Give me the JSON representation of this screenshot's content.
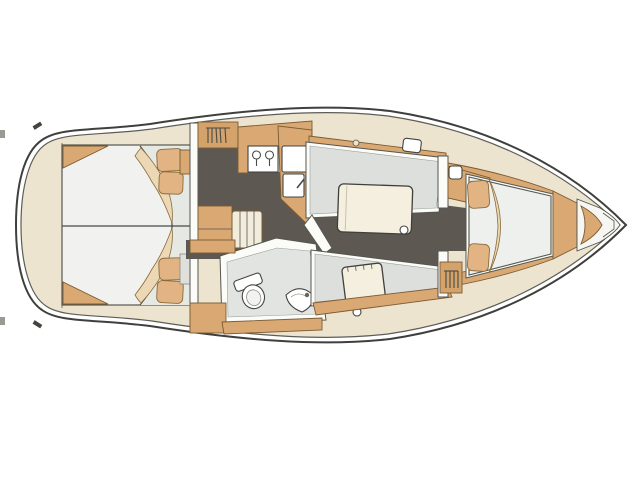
{
  "diagram": {
    "title": "Sailing yacht interior layout plan, bow pointing right",
    "colors": {
      "hull_deck": "#ece4cf",
      "wood": "#d9a873",
      "wood_deep": "#d4a26b",
      "wood_line": "#7a5c33",
      "floor": "#5e5853",
      "berth": "#eef0ed",
      "berth_aft": "#f1f2ef",
      "upholstery": "#dcdfdb",
      "head_floor": "#e2e4e1",
      "wall": "#fbfbf8",
      "table": "#f4efdf",
      "steps": "#f2ecdc",
      "pillow": "#e2b383",
      "blanket": "#ecd8b4",
      "line": "#4a4a46"
    },
    "regions": [
      {
        "label": "Aft cabin with double berths"
      },
      {
        "label": "Companionway steps"
      },
      {
        "label": "Hanging locker"
      },
      {
        "label": "Galley with two-burner stove and twin sinks"
      },
      {
        "label": "Saloon dinette with table"
      },
      {
        "label": "Head with marine toilet and washbasin"
      },
      {
        "label": "Starboard settee with chart table"
      },
      {
        "label": "Forward hanging locker"
      },
      {
        "label": "Forward V-berth cabin"
      },
      {
        "label": "Anchor locker"
      },
      {
        "label": "Hull outline and side decks"
      }
    ]
  }
}
